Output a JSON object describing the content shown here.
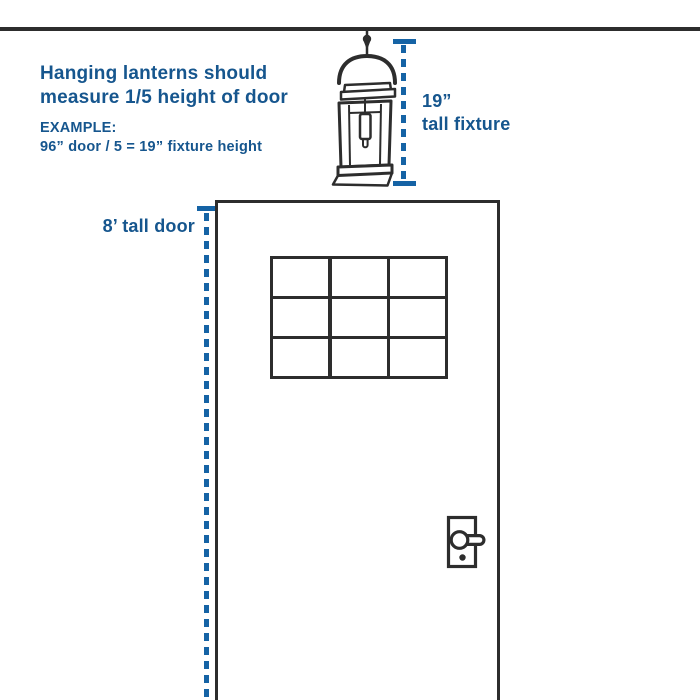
{
  "colors": {
    "accent_blue": "#16568E",
    "dash_blue": "#1563A5",
    "line_dark": "#2D2D2D",
    "background": "#FFFFFF"
  },
  "instruction": {
    "line1": "Hanging lanterns should",
    "line2": "measure 1/5 height of door",
    "example_label": "EXAMPLE:",
    "example_formula": "96” door / 5 = 19” fixture height"
  },
  "fixture_measurement": {
    "value": "19”",
    "label": "tall fixture"
  },
  "door_measurement": {
    "label": "8’ tall door"
  },
  "diagram": {
    "icons": {
      "ceiling": "ceiling-line",
      "lantern": "hanging-lantern-fixture-icon",
      "door": "front-door",
      "window": "door-window-grid",
      "handle": "door-lever-handle-icon"
    },
    "window_grid": {
      "rows": 3,
      "cols": 3
    }
  }
}
